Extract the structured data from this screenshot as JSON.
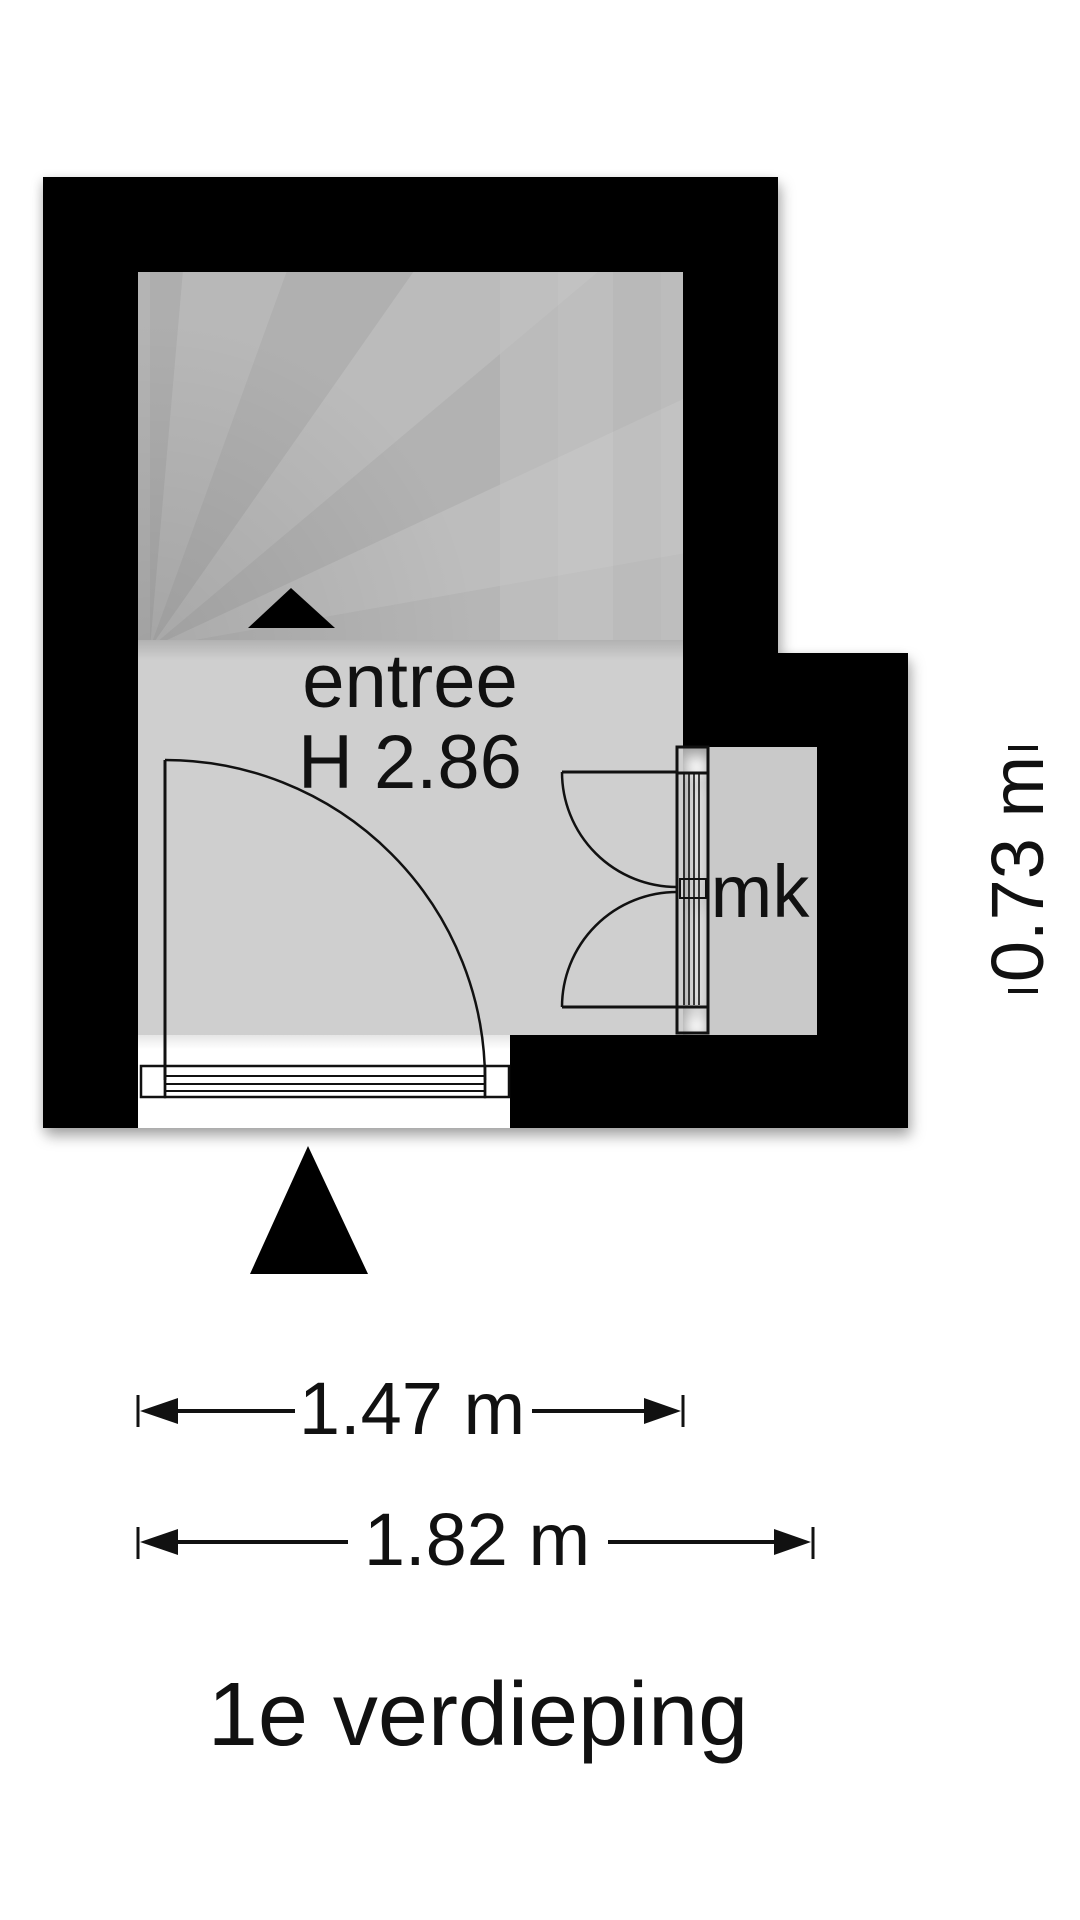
{
  "floorplan": {
    "title": "1e verdieping",
    "entree_label": "entree",
    "entree_height_label": "H 2.86",
    "closet_label": "mk",
    "dim_inner_width": "1.47 m",
    "dim_outer_width": "1.82 m",
    "dim_side": "0.73 m",
    "colors": {
      "wall": "#000000",
      "stairs": "#b4b4b4",
      "room": "#cfcfcf",
      "closet": "#c9c9c9",
      "line": "#111111",
      "background": "#ffffff"
    }
  }
}
